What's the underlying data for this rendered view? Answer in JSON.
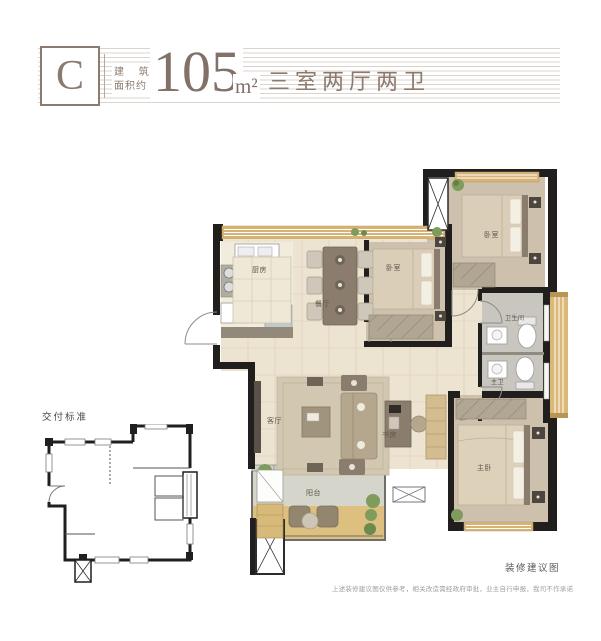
{
  "header": {
    "unit_letter": "C",
    "area_label_line1": "建 筑",
    "area_label_line2": "面积约",
    "area_value": "105",
    "area_unit": "m²",
    "layout_summary": "三室两厅两卫"
  },
  "plan": {
    "rooms": {
      "kitchen": "厨房",
      "dining": "餐厅",
      "bedroom_middle": "卧室",
      "bedroom_corner": "卧室",
      "bathroom": "卫生间",
      "master_bathroom": "主卫",
      "living_room": "客厅",
      "study": "书房",
      "master_bedroom": "主卧",
      "balcony": "阳台"
    }
  },
  "secondary_plan": {
    "title": "交付标准"
  },
  "footer": {
    "caption": "装修建议图",
    "disclaimer": "上述装修建议图仅供参考，相关改造需经政府审批，业主自行申报，我司不作承诺"
  },
  "colors": {
    "accent": "#8d7a6e",
    "wall": "#211f1d",
    "window_tan": "#d7b476"
  }
}
